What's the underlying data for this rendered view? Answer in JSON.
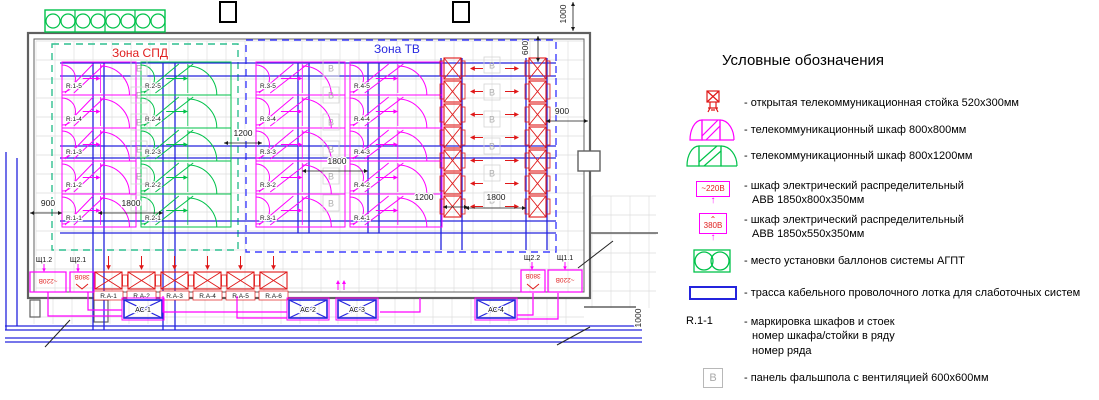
{
  "legend": {
    "title": "Условные обозначения",
    "items": [
      {
        "name": "open-rack",
        "label": "- открытая телекоммуникационная стойка 520х300мм"
      },
      {
        "name": "tk-cabinet-800",
        "label": "- телекоммуникационный шкаф 800х800мм"
      },
      {
        "name": "tk-cabinet-1200",
        "label": "- телекоммуникационный шкаф 800х1200мм"
      },
      {
        "name": "elec-cabinet-220",
        "badge": "~220В",
        "label": "- шкаф электрический распределительный",
        "label2": "АВВ 1850х800х350мм"
      },
      {
        "name": "elec-cabinet-380",
        "badge": "380В",
        "label": "- шкаф электрический распределительный",
        "label2": "АВВ 1850х550х350мм"
      },
      {
        "name": "agpt",
        "label": "- место установки баллонов системы АГПТ"
      },
      {
        "name": "tray",
        "label": "- трасса кабельного проволочного лотка для слаботочных систем"
      },
      {
        "name": "marking",
        "icon_text": "R.1-1",
        "label": "- маркировка шкафов и стоек",
        "label2": "номер шкафа/стойки в ряду",
        "label3": "номер ряда"
      },
      {
        "name": "vent-panel",
        "icon_text": "В",
        "label": "- панель фальшпола с вентиляцией 600х600мм"
      }
    ]
  },
  "plan": {
    "colors": {
      "magenta": "#ff00ff",
      "green": "#00c24a",
      "zone_tv": "#4040ff",
      "blue": "#2424dd",
      "red": "#e01818",
      "wall": "#606060",
      "grid": "#dedede",
      "dim": "#1a1a1a",
      "vent": "#b0b0b0",
      "label": "#1a1a1a",
      "ptext": "#e02020"
    },
    "zones": [
      {
        "label": "Зона СПД",
        "label_color": "#e02020",
        "stroke": "#2fbf8f",
        "x": 52,
        "y": 44,
        "w": 186,
        "h": 206,
        "lx": 140,
        "ly": 57
      },
      {
        "label": "Зона ТВ",
        "label_color": "#2828e0",
        "stroke": "#4040ff",
        "x": 246,
        "y": 40,
        "w": 310,
        "h": 212,
        "lx": 397,
        "ly": 53
      }
    ],
    "row_ys": [
      62,
      95,
      128,
      161,
      194
    ],
    "row_h": 33,
    "cabinet_rows": [
      {
        "color": "magenta",
        "x": 62,
        "w": 74,
        "labels": [
          "R.1-5",
          "R.1-4",
          "R.1-3",
          "R.1-2",
          "R.1-1"
        ]
      },
      {
        "color": "green",
        "x": 141,
        "w": 90,
        "labels": [
          "R.2-5",
          "R.2-4",
          "R.2-3",
          "R.2-2",
          "R.2-1"
        ]
      },
      {
        "color": "magenta",
        "x": 256,
        "w": 89,
        "labels": [
          "R.3-5",
          "R.3-4",
          "R.3-3",
          "R.3-2",
          "R.3-1"
        ]
      },
      {
        "color": "magenta",
        "x": 350,
        "w": 92,
        "labels": [
          "R.4-5",
          "R.4-4",
          "R.4-3",
          "R.4-2",
          "R.4-1"
        ]
      }
    ],
    "rack_cols": {
      "xs": [
        444,
        529
      ],
      "w": 17,
      "ys": [
        58,
        81,
        104,
        127,
        150,
        173,
        196
      ],
      "h": 21
    },
    "bottom_racks": {
      "labels": [
        "R.A-1",
        "R.A-2",
        "R.A-3",
        "R.A-4",
        "R.A-5",
        "R.A-6"
      ],
      "xs": [
        95,
        128,
        161,
        194,
        227,
        260
      ],
      "y": 272,
      "w": 27,
      "h": 17
    },
    "ac_units": {
      "labels": [
        "АС-1",
        "АС-2",
        "АС-3",
        "АС-4"
      ],
      "xs": [
        124,
        289,
        338,
        477
      ],
      "y": 300,
      "w": 38,
      "h": 18
    },
    "power_labels": [
      {
        "t": "Щ1.2",
        "x": 44,
        "y": 262
      },
      {
        "t": "Щ2.1",
        "x": 78,
        "y": 262
      },
      {
        "t": "Щ2.2",
        "x": 532,
        "y": 260
      },
      {
        "t": "Щ1.1",
        "x": 565,
        "y": 260
      }
    ],
    "power_boxes": [
      {
        "t": "~220В",
        "x": 30,
        "y": 272,
        "w": 36,
        "h": 20,
        "zig": false
      },
      {
        "t": "380В",
        "x": 70,
        "y": 272,
        "w": 24,
        "h": 20,
        "zig": true
      },
      {
        "t": "380В",
        "x": 521,
        "y": 270,
        "w": 24,
        "h": 22,
        "zig": true
      },
      {
        "t": "~220В",
        "x": 548,
        "y": 270,
        "w": 34,
        "h": 22,
        "zig": false
      }
    ],
    "vent_letter": "В",
    "vent_cols": [
      {
        "x": 139,
        "ys": [
          68,
          95,
          122,
          149,
          176,
          203
        ]
      },
      {
        "x": 331,
        "ys": [
          68,
          95,
          122,
          149,
          176,
          203
        ]
      },
      {
        "x": 492,
        "ys": [
          65,
          92,
          119,
          146,
          173,
          200
        ]
      }
    ],
    "dims": [
      {
        "t": "900",
        "x": 48,
        "y": 206,
        "line": [
          30,
          213,
          62,
          213
        ]
      },
      {
        "t": "1800",
        "x": 131,
        "y": 206,
        "line": [
          98,
          213,
          163,
          213
        ]
      },
      {
        "t": "1200",
        "x": 243,
        "y": 136,
        "line": [
          224,
          143,
          262,
          143
        ]
      },
      {
        "t": "1800",
        "x": 337,
        "y": 164,
        "line": [
          302,
          171,
          368,
          171
        ]
      },
      {
        "t": "1200",
        "x": 424,
        "y": 200,
        "line": [
          443,
          207,
          468,
          207
        ]
      },
      {
        "t": "1800",
        "x": 496,
        "y": 200,
        "line": [
          465,
          208,
          526,
          208
        ]
      },
      {
        "t": "900",
        "x": 562,
        "y": 114,
        "line": [
          546,
          121,
          588,
          121
        ]
      },
      {
        "t": "600",
        "x": 528,
        "y": 48,
        "rot": true,
        "line": [
          538,
          36,
          538,
          62
        ]
      },
      {
        "t": "1000",
        "x": 566,
        "y": 14,
        "rot": true,
        "line": [
          573,
          2,
          573,
          31
        ]
      },
      {
        "t": "1000",
        "x": 641,
        "y": 318,
        "rot": true
      }
    ],
    "trays": {
      "h": [
        [
          60,
          556,
          63
        ],
        [
          60,
          556,
          76
        ],
        [
          60,
          556,
          146
        ],
        [
          60,
          556,
          158
        ],
        [
          60,
          556,
          221
        ],
        [
          60,
          556,
          233
        ],
        [
          5,
          642,
          326
        ],
        [
          5,
          642,
          330
        ],
        [
          5,
          642,
          338
        ],
        [
          5,
          642,
          342
        ]
      ],
      "v": [
        [
          93,
          63,
          330
        ],
        [
          104,
          63,
          330
        ],
        [
          163,
          63,
          330
        ],
        [
          175,
          63,
          330
        ],
        [
          298,
          63,
          233
        ],
        [
          309,
          63,
          233
        ],
        [
          368,
          63,
          233
        ],
        [
          379,
          63,
          233
        ],
        [
          441,
          58,
          250
        ],
        [
          462,
          58,
          250
        ],
        [
          526,
          58,
          250
        ],
        [
          547,
          58,
          250
        ],
        [
          6,
          152,
          330
        ],
        [
          17,
          158,
          326
        ]
      ]
    },
    "routes": [
      [
        [
          48,
          292
        ],
        [
          48,
          316
        ],
        [
          122,
          316
        ]
      ],
      [
        [
          88,
          292
        ],
        [
          88,
          310
        ],
        [
          122,
          310
        ]
      ],
      [
        [
          163,
          296
        ],
        [
          163,
          312
        ],
        [
          287,
          312
        ]
      ],
      [
        [
          237,
          296
        ],
        [
          237,
          318
        ],
        [
          287,
          318
        ]
      ],
      [
        [
          420,
          298
        ],
        [
          420,
          312
        ],
        [
          380,
          312
        ]
      ],
      [
        [
          533,
          293
        ],
        [
          533,
          315
        ],
        [
          517,
          315
        ]
      ],
      [
        [
          558,
          293
        ],
        [
          558,
          319
        ],
        [
          517,
          319
        ]
      ]
    ],
    "walls": {
      "outer": [
        28,
        33,
        562,
        265
      ],
      "inner": [
        34,
        39,
        550,
        253
      ],
      "lines": [
        [
          590,
          233,
          658,
          233
        ],
        [
          584,
          307,
          636,
          307
        ]
      ],
      "pier": [
        578,
        151,
        22,
        20
      ],
      "stubs": [
        [
          30,
          300,
          10,
          17
        ],
        [
          94,
          300,
          14,
          22
        ]
      ]
    },
    "columns": [
      [
        220,
        2,
        16,
        20
      ],
      [
        453,
        2,
        16,
        20
      ]
    ],
    "agpt": {
      "x": 45,
      "y": 10,
      "w": 120,
      "h": 22,
      "cells": 4
    },
    "leaders": [
      [
        45,
        347,
        70,
        320
      ],
      [
        557,
        345,
        590,
        327
      ],
      [
        578,
        268,
        613,
        241
      ]
    ],
    "up_arrows": {
      "x": 338,
      "y": 282
    },
    "grid_areas": [
      [
        36,
        41,
        548,
        251
      ],
      [
        592,
        196,
        64,
        112
      ],
      [
        34,
        298,
        550,
        26
      ]
    ],
    "grid_step": 19
  }
}
